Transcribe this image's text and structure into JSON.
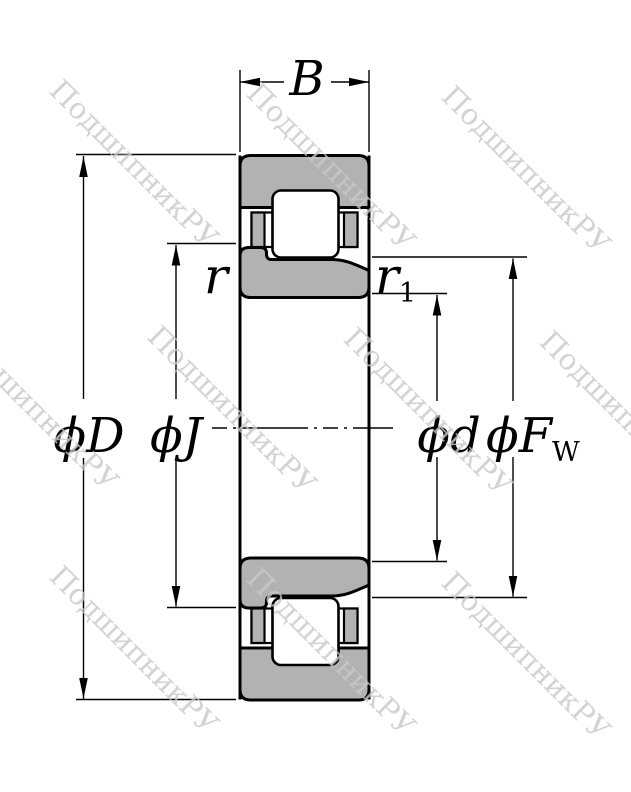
{
  "colors": {
    "ring_fill": "#b2b2b2",
    "line": "#000000",
    "background": "#ffffff",
    "watermark": "#c9c9c9"
  },
  "labels": {
    "width": "B",
    "outer_diameter": "ϕD",
    "rib_diameter": "ϕJ",
    "bore_diameter": "ϕd",
    "raceway_diameter_main": "ϕF",
    "raceway_diameter_sub": "W",
    "chamfer": "r",
    "chamfer_inner_main": "r",
    "chamfer_inner_sub": "1"
  },
  "watermark": {
    "text": "ПодшипникРУ"
  }
}
